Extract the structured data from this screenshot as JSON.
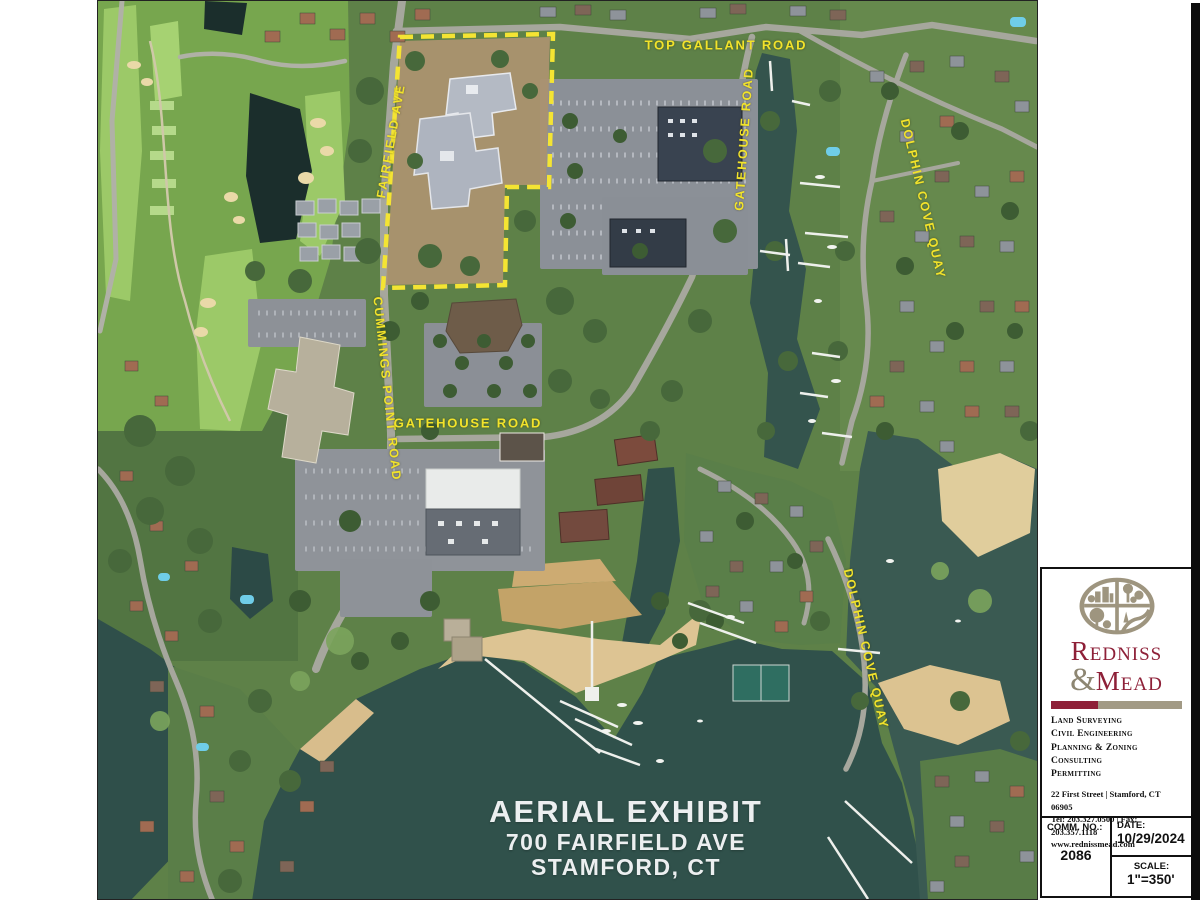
{
  "map": {
    "road_labels": {
      "top_gallant": "TOP GALLANT ROAD",
      "fairfield_ave": "FAIRFIELD AVE",
      "gatehouse_upper": "GATEHOUSE ROAD",
      "dolphin_cove_upper": "DOLPHIN COVE QUAY",
      "cummings_point": "CUMMINGS POINT ROAD",
      "gatehouse_center": "GATEHOUSE ROAD",
      "dolphin_cove_lower": "DOLPHIN COVE QUAY"
    },
    "title": {
      "line1": "AERIAL EXHIBIT",
      "line2": "700 FAIRFIELD AVE",
      "line3": "STAMFORD, CT"
    },
    "label_color": "#f2e32b",
    "boundary_color": "#f4e433"
  },
  "title_block": {
    "firm_name_top": "Redniss",
    "firm_amp": "&",
    "firm_name_bottom": "Mead",
    "services": [
      "Land Surveying",
      "Civil Engineering",
      "Planning & Zoning Consulting",
      "Permitting"
    ],
    "address": "22 First Street | Stamford, CT 06905",
    "phone_fax": "Tel: 203.327.0500 | Fax: 203.357.1118",
    "website": "www.rednissmead.com",
    "comm_no_label": "COMM. NO.:",
    "comm_no_value": "2086",
    "date_label": "DATE:",
    "date_value": "10/29/2024",
    "scale_label": "SCALE:",
    "scale_value": "1\"=350'",
    "brand_crimson": "#8e2038",
    "brand_taupe": "#a29a85"
  }
}
